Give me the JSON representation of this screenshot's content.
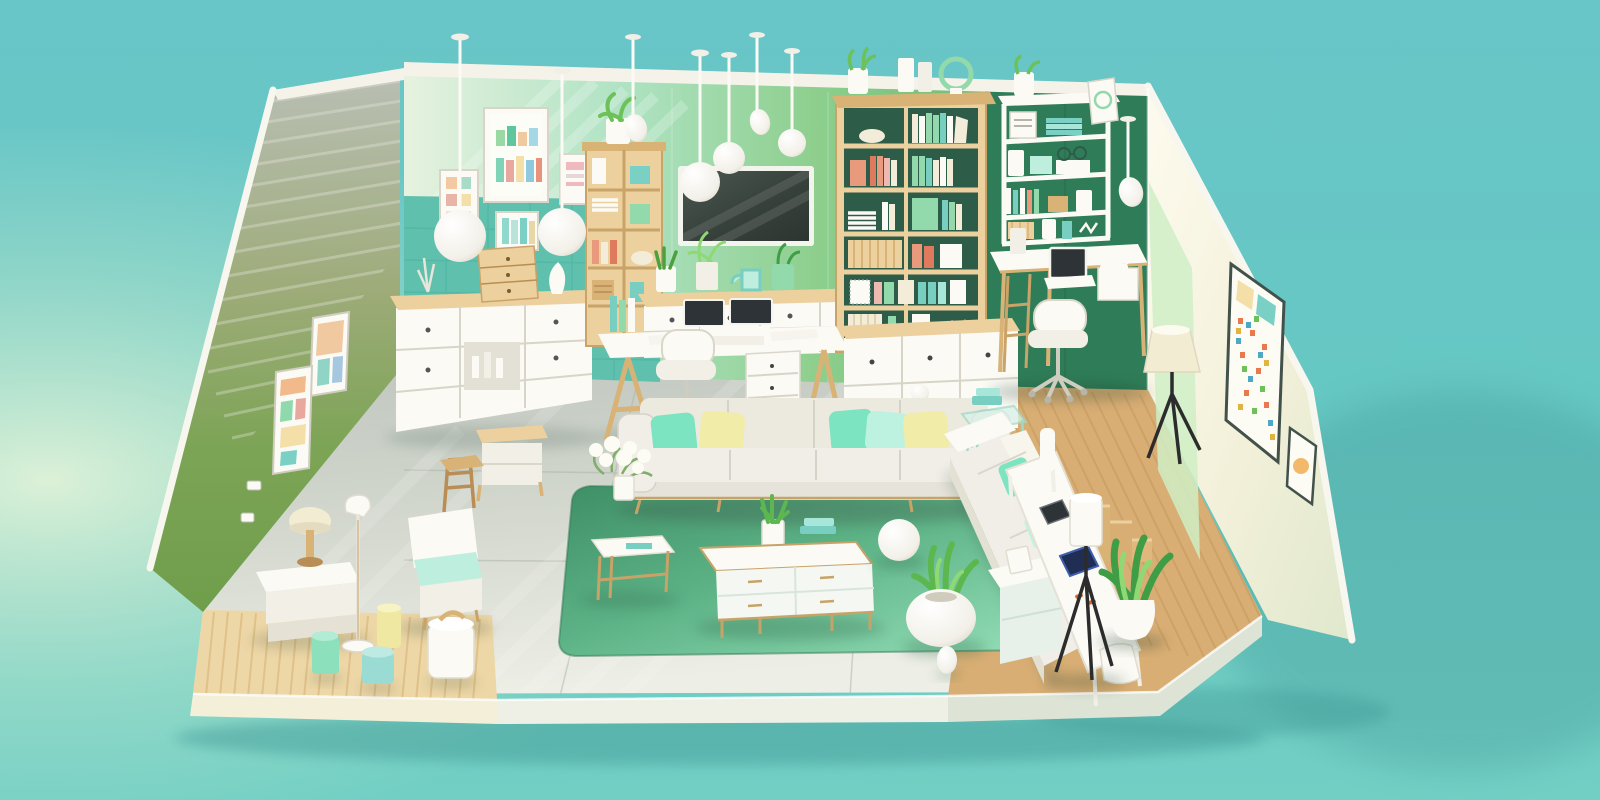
{
  "scene": {
    "title": "Isometric cutaway illustration of a mint-and-teal living room with home office",
    "style": "3D isometric room render, pastel palette, no visible text",
    "palette": {
      "bg_top": "#69c6c8",
      "bg_bottom": "#74cfc5",
      "bg_glow": "#e2f3da",
      "bg_shadow": "#3e9694",
      "ridge_white": "#f8f7ef",
      "ceiling": "#f5f3e9",
      "wall_back_dark": "#2f7d58",
      "wall_tile_teal": "#5fc0ae",
      "tile_line": "#4db4a2",
      "wall_right_cream": "#f8f4e3",
      "wall_right_green": "#cfeec6",
      "floor_tile": "#c9cfc7",
      "floor_line": "#aab1a8",
      "wood_floor_left": "#eed7a6",
      "wood_floor_right": "#d9ae74",
      "plank_left": "#d8b87e",
      "plank_right": "#c3995c",
      "platform_left": "#f4efd8",
      "platform_mid": "#eef0e6",
      "platform_right": "#dde4d6",
      "rug_dark": "#3f8e66",
      "rug_light": "#97e0ba",
      "white": "#fbfaf5",
      "off_white": "#efede4",
      "sofa_body": "#e5e3da",
      "sofa_cushion": "#f0eee6",
      "pillow_mint": "#7de4c2",
      "pillow_pale": "#bdf2e0",
      "pillow_yellow": "#f1eca8",
      "brass": "#c7a368",
      "wood_light": "#ecd09e",
      "wood_mid": "#d9b276",
      "wood_dark": "#b98d55",
      "tv_frame": "#f4f4ee",
      "tv_screen": "#39433d",
      "screen_dark": "#2e3338",
      "tablet_navy": "#1f2e52",
      "shelf_back": "#2d5c49",
      "book_coral": "#ea9a7c",
      "book_red": "#e07a5f",
      "book_mint": "#92d9ac",
      "book_teal": "#79cec2",
      "book_cream": "#f3ecd8",
      "book_yellow": "#e9d88e",
      "book_pink": "#eeb9b0",
      "plant_green": "#6cc258",
      "plant_dark": "#3f9e45",
      "leaf_mint": "#8fd974",
      "lamp_cream": "#f2ecd2",
      "tripod_black": "#2c2c2c",
      "stool_mint": "#8ce0bc",
      "stool_aqua": "#9adcd4",
      "stool_yellow": "#efe8a2",
      "teal_accent": "#7ad0c4",
      "mint_accent": "#bdeede",
      "poster_white": "#fdfcf4",
      "accent_orange": "#e0642f"
    },
    "objects": [
      {
        "id": "pendant-lamps",
        "label": "Eight white ceiling pendant lamps with ball and spoon shades"
      },
      {
        "id": "bar-chart-poster",
        "label": "Framed pastel bar-chart art print on back wall"
      },
      {
        "id": "small-wall-frames",
        "label": "Three small pastel art frames on back wall"
      },
      {
        "id": "left-wall-frames",
        "label": "Two colorful collage frames on left wall"
      },
      {
        "id": "tv",
        "label": "Wall-mounted flat screen TV"
      },
      {
        "id": "media-console",
        "label": "White media console with dual monitors and plants"
      },
      {
        "id": "trestle-desk",
        "label": "White trestle desk with books, keyboard and papers"
      },
      {
        "id": "desk-chair",
        "label": "White swivel desk chair"
      },
      {
        "id": "caster-drawer-unit",
        "label": "White rolling drawer unit"
      },
      {
        "id": "large-bookshelf",
        "label": "Tall wooden bookshelf filled with pastel books"
      },
      {
        "id": "drawer-cabinet",
        "label": "White drawer cabinet under bookshelf"
      },
      {
        "id": "wall-shelf-right",
        "label": "White wall shelf unit with boxes and books"
      },
      {
        "id": "study-desk-right",
        "label": "Wooden study desk with laptop and lamp"
      },
      {
        "id": "study-chair-right",
        "label": "White swivel chair at study desk"
      },
      {
        "id": "poster-collage-right",
        "label": "Colorful confetti collage poster on right wall"
      },
      {
        "id": "small-frame-right",
        "label": "Small framed print on right wall"
      },
      {
        "id": "sideboard-left",
        "label": "White sideboard with wooden top, bottles and mini drawer tower"
      },
      {
        "id": "small-bookshelf-back",
        "label": "Small wooden cubby shelf with plant on top"
      },
      {
        "id": "main-sofa",
        "label": "Light grey sofa with mint and yellow pillows"
      },
      {
        "id": "ball-floor-lamp",
        "label": "Slim ball-top floor lamp behind sofa"
      },
      {
        "id": "green-rug",
        "label": "Large green area rug"
      },
      {
        "id": "coffee-table",
        "label": "White and brass coffee table with succulent and books"
      },
      {
        "id": "side-table",
        "label": "Brass-frame side table with white flower bouquet"
      },
      {
        "id": "sphere-pouf",
        "label": "White sphere pouf"
      },
      {
        "id": "round-planter",
        "label": "Round white planter with aloe plant"
      },
      {
        "id": "egg-speaker",
        "label": "Small white egg-shaped speaker"
      },
      {
        "id": "right-sofa",
        "label": "Cream chaise sofa with mint pillows"
      },
      {
        "id": "glass-side-table",
        "label": "Glass cube side table with teal books"
      },
      {
        "id": "right-console-cabinet",
        "label": "White cabinet at end of chaise"
      },
      {
        "id": "tablet-desk",
        "label": "White desk with two tablet devices"
      },
      {
        "id": "tripod-lamps",
        "label": "Two black tripod floor lamps with white shades"
      },
      {
        "id": "potted-plant-right",
        "label": "White pot with tall green leaves"
      },
      {
        "id": "step-shelf",
        "label": "Small wooden step shelf in corner"
      },
      {
        "id": "left-bench",
        "label": "White bench with cream mushroom table lamp"
      },
      {
        "id": "slim-floor-lamp",
        "label": "Thin white floor lamp"
      },
      {
        "id": "left-armchair",
        "label": "White armchair with mint cushion"
      },
      {
        "id": "wood-high-chair",
        "label": "Wooden ladder-back chair"
      },
      {
        "id": "wood-console-left",
        "label": "Small wooden console table"
      },
      {
        "id": "accent-stools",
        "label": "Mint, aqua, yellow and white cylinder stools"
      },
      {
        "id": "wall-outlets",
        "label": "White power outlets on left wall"
      }
    ]
  }
}
